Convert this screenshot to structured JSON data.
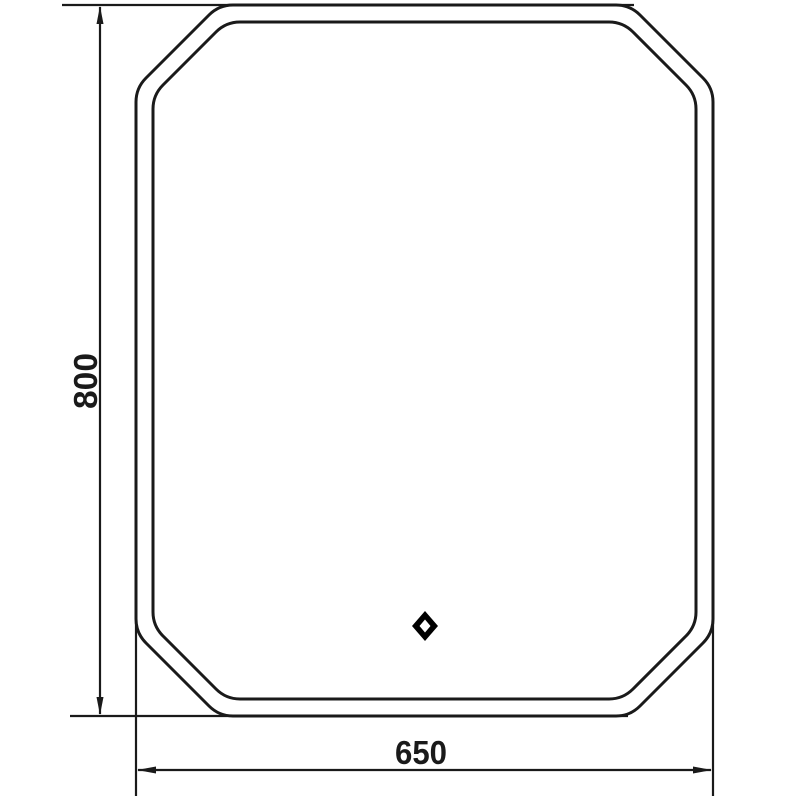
{
  "page": {
    "background": "#ffffff"
  },
  "colors": {
    "line": "#1a1a1a",
    "label_text": "#1a1a1a",
    "sensor_fill": "#000000",
    "sensor_hole": "#ffffff"
  },
  "dimensions": {
    "height": {
      "label": "800",
      "value": 800
    },
    "width": {
      "label": "650",
      "value": 650
    }
  },
  "drawing": {
    "subject": "octagonal mirror outline with chamfered corners, double contour, front view",
    "touch_sensor_icon": "diamond-icon"
  }
}
